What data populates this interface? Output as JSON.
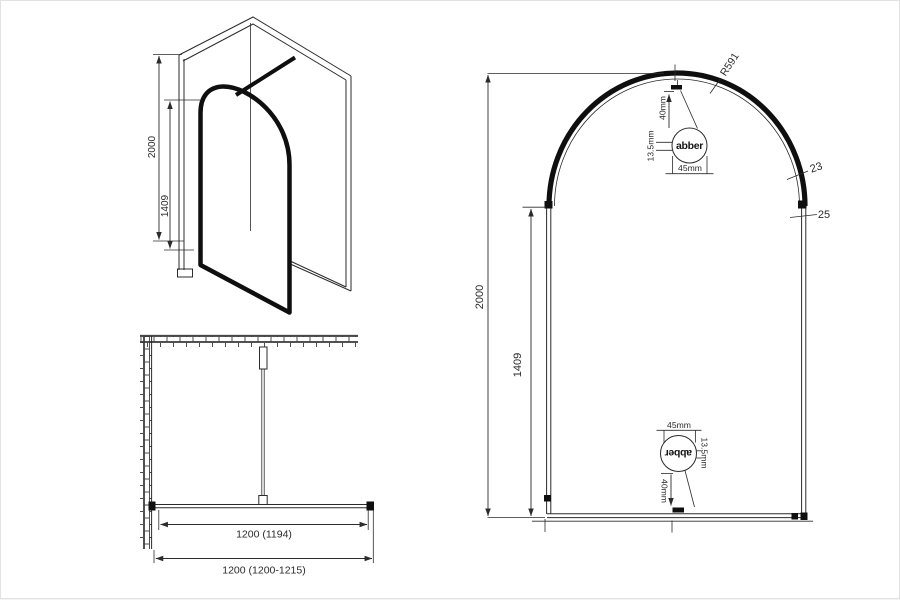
{
  "drawing": {
    "title_semantic": "shower-screen-technical-drawing",
    "colors": {
      "background": "#ffffff",
      "line": "#2b2b2b",
      "frame_black": "#0f0f0f"
    },
    "iso_view": {
      "height_label": "2000",
      "door_height_label": "1409"
    },
    "plan_view": {
      "inner_width_label": "1200 (1194)",
      "outer_width_label": "1200 (1200-1215)"
    },
    "front_view": {
      "height_label": "2000",
      "side_height_label": "1409",
      "radius_label": "R591",
      "frame_thickness_label": "23",
      "profile_width_label": "25",
      "top_callout": {
        "brand_logo": "abber",
        "offset_label": "40mm",
        "thickness_label": "13.5mm",
        "width_label": "45mm"
      },
      "bottom_callout": {
        "brand_logo": "abber",
        "offset_label": "40mm",
        "thickness_label": "13.5mm",
        "width_label": "45mm"
      }
    }
  }
}
